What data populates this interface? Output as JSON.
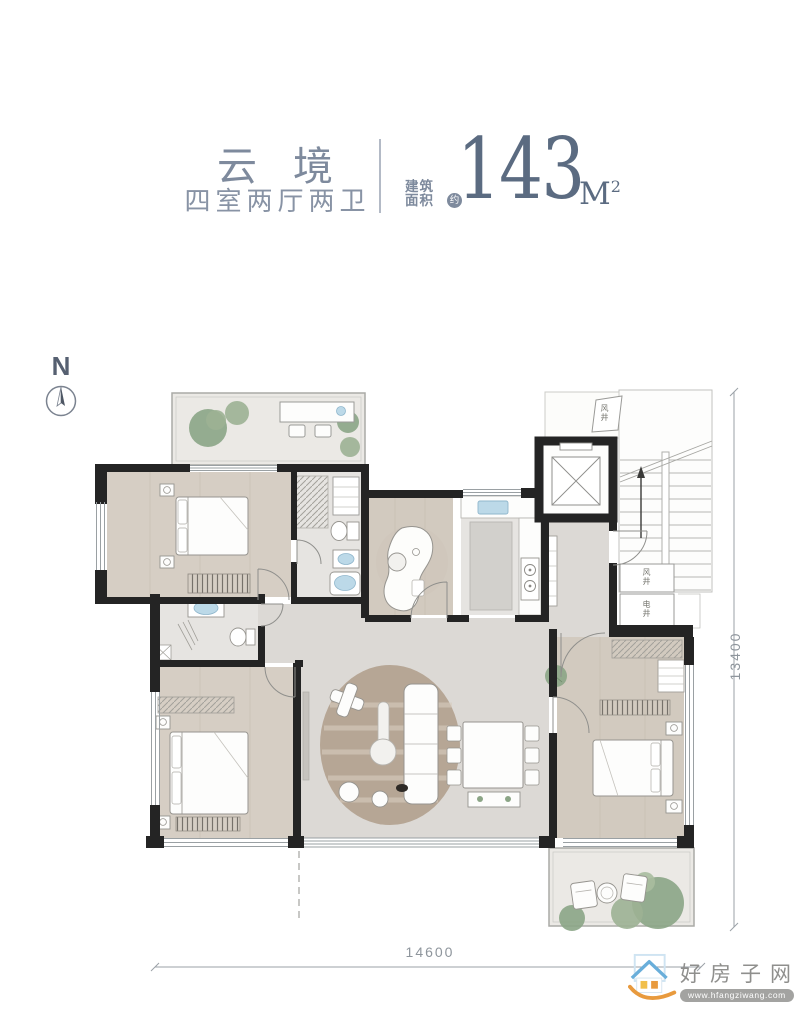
{
  "header": {
    "title": "云境",
    "subtitle": "四室两厅两卫",
    "area_label_line1": "建筑",
    "area_label_line2": "面积",
    "area_approx_badge": "约",
    "area_value": "143",
    "area_unit": "M",
    "area_unit_exponent": "2"
  },
  "compass": {
    "north_label": "N"
  },
  "plan": {
    "shafts": {
      "top_label": "风井",
      "right_upper_label": "风井",
      "right_lower_label": "电井"
    },
    "dimensions": {
      "bottom_width": "14600",
      "right_height": "13400"
    }
  },
  "watermark": {
    "site_name": "好房子网",
    "site_url": "www.hfangziwang.com"
  },
  "palette": {
    "accent_text": "#7e8a9d",
    "area_number": "#5b6b81",
    "wall_black": "#242424",
    "wood_floor": "#d6cec4",
    "marble_floor": "#dcd9d5",
    "tile_floor": "#e6e4e1",
    "terrace_floor": "#ebe9e5",
    "plant_green": "#8ba586",
    "water_blue": "#bcd9e8",
    "rug_brown": "#b6a695",
    "dimension_text": "#8e959c",
    "watermark_blue": "#69aeda",
    "watermark_orange": "#e89a3e"
  }
}
